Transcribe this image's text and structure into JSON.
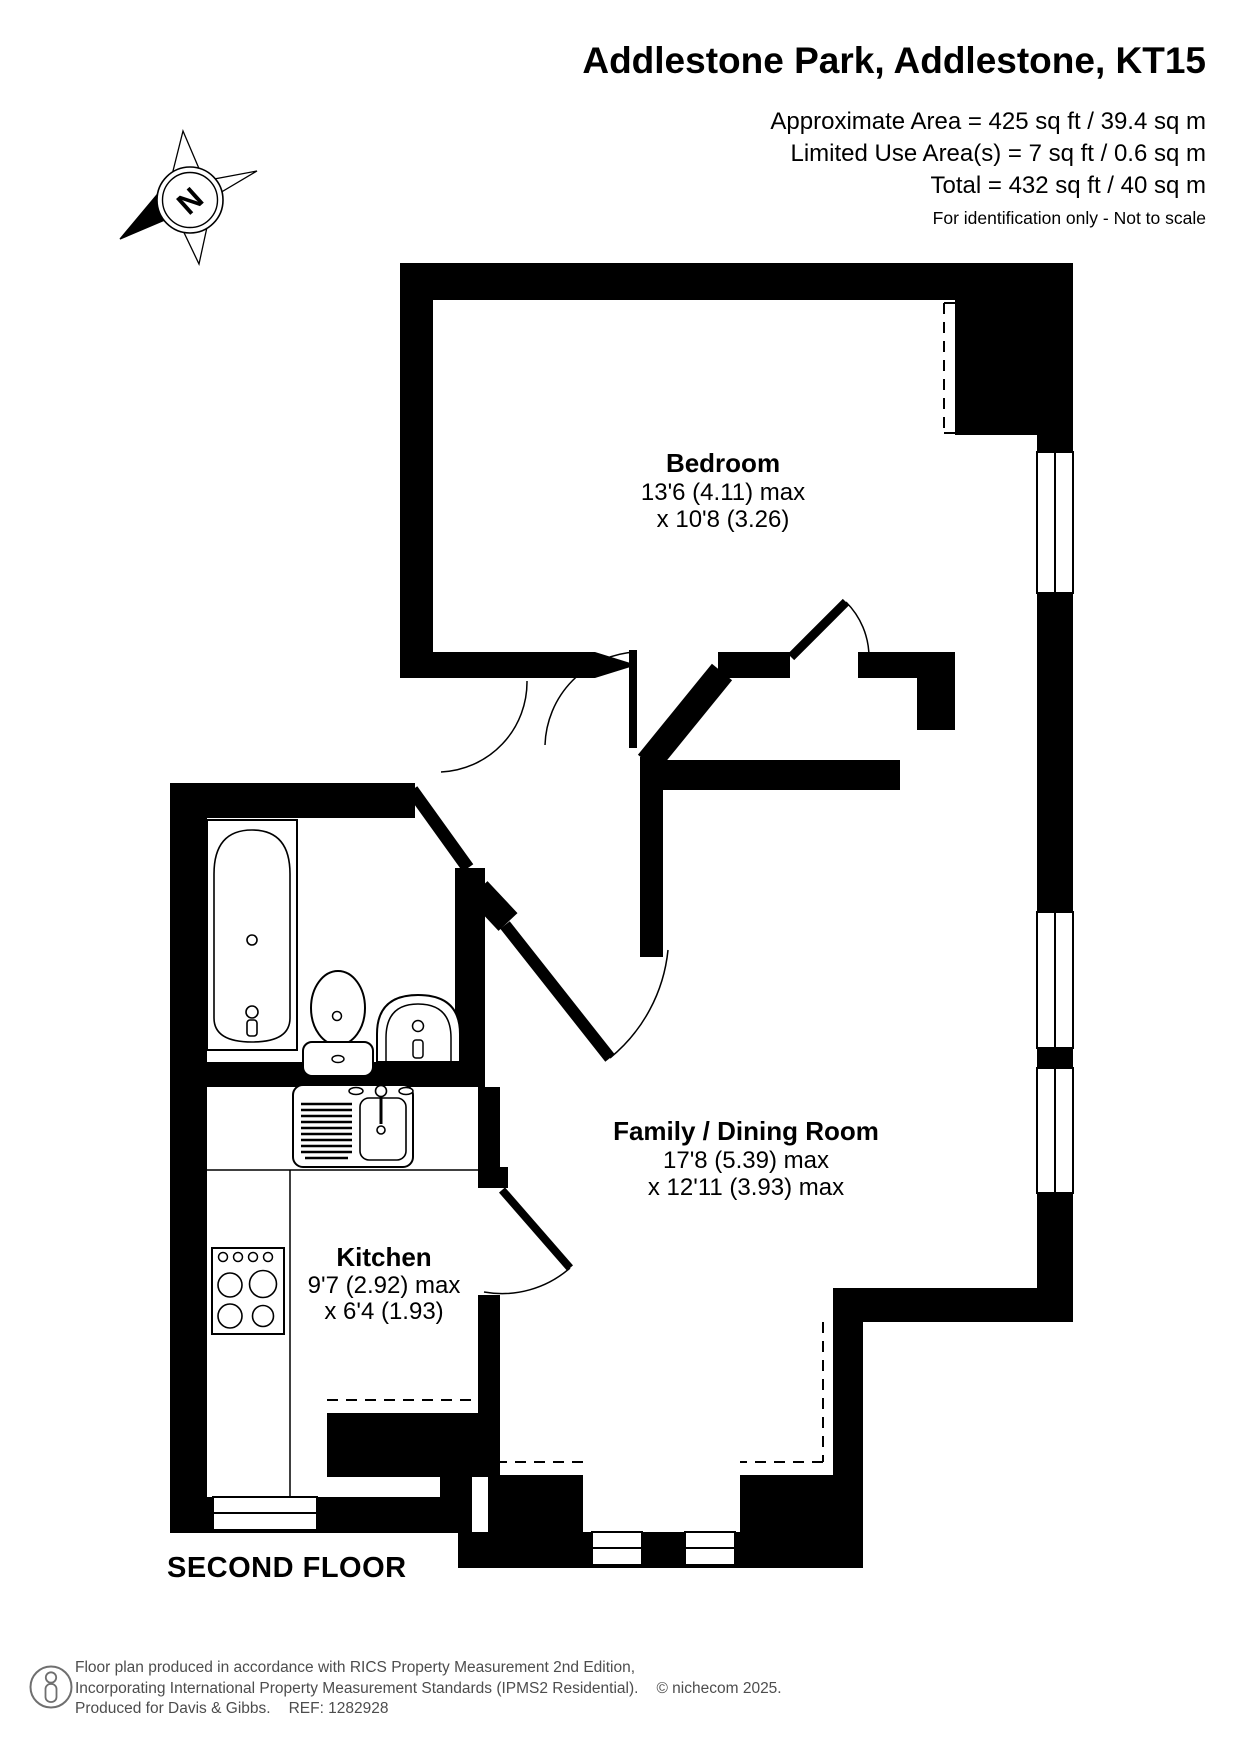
{
  "header": {
    "title": "Addlestone Park, Addlestone, KT15",
    "area1": "Approximate Area = 425 sq ft / 39.4 sq m",
    "area2": "Limited Use Area(s) = 7 sq ft / 0.6 sq m",
    "area3": "Total = 432 sq ft / 40 sq m",
    "disclaimer": "For identification only - Not to scale"
  },
  "compass": {
    "north_label": "N"
  },
  "rooms": {
    "bedroom": {
      "name": "Bedroom",
      "dim_line1": "13'6 (4.11) max",
      "dim_line2": "x 10'8 (3.26)"
    },
    "family_dining": {
      "name": "Family / Dining Room",
      "dim_line1": "17'8 (5.39) max",
      "dim_line2": "x 12'11 (3.93) max"
    },
    "kitchen": {
      "name": "Kitchen",
      "dim_line1": "9'7 (2.92) max",
      "dim_line2": "x 6'4 (1.93)"
    }
  },
  "floor_label": "SECOND FLOOR",
  "footer": {
    "line1": "Floor plan produced in accordance with RICS Property Measurement 2nd Edition,",
    "line2": "Incorporating International Property Measurement Standards (IPMS2 Residential).",
    "copyright": "© nichecom 2025.",
    "line3_left": "Produced for Davis & Gibbs.",
    "ref": "REF: 1282928"
  },
  "colors": {
    "walls": "#000000",
    "footer_text": "#4d4d4d"
  }
}
